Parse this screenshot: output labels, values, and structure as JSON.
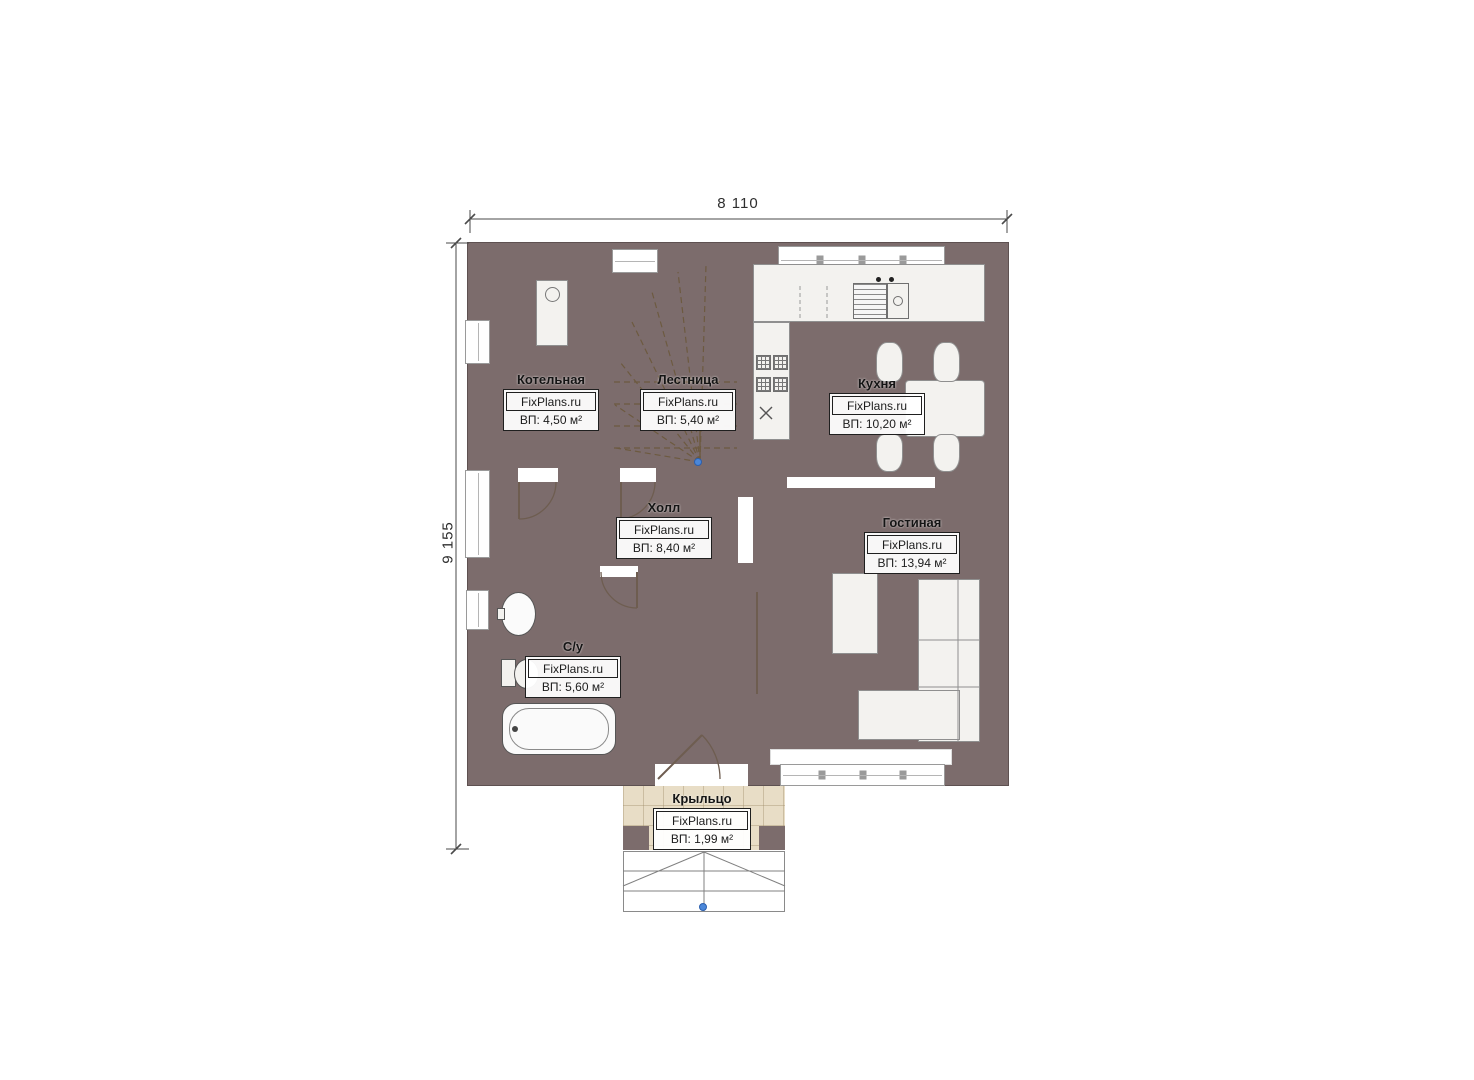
{
  "brand": "FixPlans.ru",
  "dimensions": {
    "top": "8 110",
    "left": "9 155"
  },
  "rooms": [
    {
      "name": "Котельная",
      "area": "ВП: 4,50 м²"
    },
    {
      "name": "Лестница",
      "area": "ВП: 5,40 м²"
    },
    {
      "name": "Кухня",
      "area": "ВП: 10,20 м²"
    },
    {
      "name": "Холл",
      "area": "ВП: 8,40 м²"
    },
    {
      "name": "Гостиная",
      "area": "ВП: 13,94 м²"
    },
    {
      "name": "С/у",
      "area": "ВП: 5,60 м²"
    },
    {
      "name": "Крыльцо",
      "area": "ВП: 1,99 м²"
    }
  ],
  "colors": {
    "wall": "#7c6c6c",
    "floor_tan": "#d2b88d",
    "floor_gray": "#e2e1df",
    "floor_blue": "#aad2ef",
    "porch_floor": "#e8ddc6",
    "marker_blue": "#4b87d9"
  }
}
